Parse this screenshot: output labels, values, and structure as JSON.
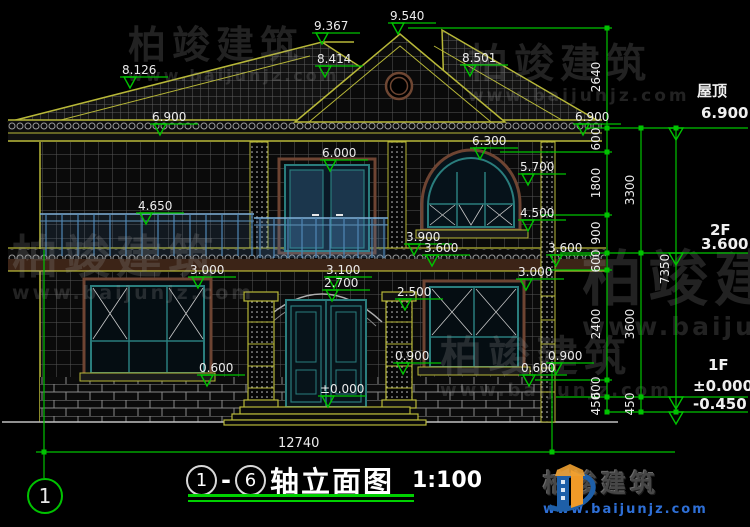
{
  "drawing": {
    "green": "#00c300",
    "view_title": {
      "c1": "1",
      "dash": "-",
      "c2": "6",
      "text": "轴立面图",
      "scale": "1:100"
    },
    "axis_bubble": "1",
    "bottom_dim": "12740",
    "logo": {
      "name": "柏竣建筑",
      "url": "www.baijunjz.com"
    },
    "watermark": {
      "name": "柏竣建筑",
      "url": "www.baijunjz.com",
      "stamps": [
        {
          "x": 128,
          "y": 26,
          "s": 38
        },
        {
          "x": 468,
          "y": 44,
          "s": 40
        },
        {
          "x": 12,
          "y": 234,
          "s": 46
        },
        {
          "x": 582,
          "y": 250,
          "s": 60
        },
        {
          "x": 440,
          "y": 336,
          "s": 42
        }
      ]
    },
    "elevation_markers": [
      {
        "v": "9.367",
        "x": 322,
        "y": 33
      },
      {
        "v": "9.540",
        "x": 398,
        "y": 23
      },
      {
        "v": "8.501",
        "x": 470,
        "y": 65
      },
      {
        "v": "8.414",
        "x": 325,
        "y": 66
      },
      {
        "v": "8.126",
        "x": 130,
        "y": 77
      },
      {
        "v": "6.900",
        "x": 160,
        "y": 124
      },
      {
        "v": "6.900",
        "x": 583,
        "y": 124
      },
      {
        "v": "6.000",
        "x": 330,
        "y": 160
      },
      {
        "v": "6.300",
        "x": 480,
        "y": 148
      },
      {
        "v": "5.700",
        "x": 528,
        "y": 174
      },
      {
        "v": "4.650",
        "x": 146,
        "y": 213
      },
      {
        "v": "4.500",
        "x": 528,
        "y": 220
      },
      {
        "v": "3.900",
        "x": 414,
        "y": 244
      },
      {
        "v": "3.600",
        "x": 432,
        "y": 255
      },
      {
        "v": "3.600",
        "x": 556,
        "y": 255
      },
      {
        "v": "3.000",
        "x": 198,
        "y": 277
      },
      {
        "v": "3.000",
        "x": 526,
        "y": 279
      },
      {
        "v": "3.100",
        "x": 334,
        "y": 277
      },
      {
        "v": "2.700",
        "x": 332,
        "y": 290
      },
      {
        "v": "2.500",
        "x": 405,
        "y": 299
      },
      {
        "v": "0.900",
        "x": 403,
        "y": 363
      },
      {
        "v": "0.900",
        "x": 556,
        "y": 363
      },
      {
        "v": "0.600",
        "x": 207,
        "y": 375
      },
      {
        "v": "0.600",
        "x": 529,
        "y": 375
      },
      {
        "v": "±0.000",
        "x": 328,
        "y": 396
      }
    ],
    "right_levels": [
      {
        "name": "屋顶",
        "nx": 697,
        "ny": 84,
        "value": "6.900",
        "vx": 701,
        "vy": 106,
        "y": 128
      },
      {
        "name": "2F",
        "nx": 710,
        "ny": 223,
        "value": "3.600",
        "vx": 701,
        "vy": 237,
        "y": 253
      },
      {
        "name": "1F",
        "nx": 708,
        "ny": 358,
        "value": "±0.000",
        "vx": 693,
        "vy": 379,
        "y": 397
      },
      {
        "name": "",
        "nx": 0,
        "ny": 0,
        "value": "-0.450",
        "vx": 693,
        "vy": 397,
        "y": 412
      }
    ],
    "dim_chains": [
      {
        "x": 607,
        "nodes": [
          28,
          128,
          152,
          215,
          253,
          270,
          380,
          397,
          412
        ],
        "labels": [
          "2640",
          "600",
          "1800",
          "900",
          "600",
          "2400",
          "600",
          "450"
        ]
      },
      {
        "x": 641,
        "nodes": [
          128,
          253,
          397,
          412
        ],
        "labels": [
          "3300",
          "3600",
          "450"
        ]
      },
      {
        "x": 676,
        "nodes": [
          128,
          412
        ],
        "labels": [
          "7350"
        ]
      }
    ]
  }
}
